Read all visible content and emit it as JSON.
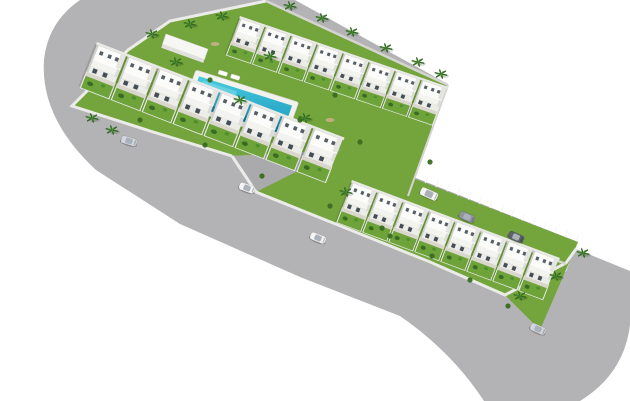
{
  "scene": {
    "description": "Aerial 3D architectural render of a residential development: two echelon blocks of white two-storey townhouses with private gardens, a communal lawn with swimming pool and palm trees, a wide light-gray perimeter road sweeping from the top-left corner to the bottom-right corner, and an internal parking street with marked bays and parked vehicles.",
    "background": "#ffffff",
    "colors": {
      "road": "#b3b3b5",
      "road_dark": "#aaaaac",
      "curb": "#ebebe9",
      "wall": "#d4d4d1",
      "grass": "#74a43c",
      "garden": "#6da339",
      "patio": "#d9d6cb",
      "pool_deck": "#f2f2ee",
      "pool_water_light": "#49ccdf",
      "pool_water_deep": "#1693ba",
      "pool_edge_shadow": "#0d7796",
      "house_roof": "#fbfbf9",
      "house_terrace": "#f3f3f0",
      "house_front": "#ecece9",
      "house_rear": "#e9e9e6",
      "house_shade": "#e4e4e1",
      "house_side_shade": "#cfcfcb",
      "window": "#454d56",
      "window_upper": "#565e66",
      "stripe": "#f6f6f6",
      "palm": "#2f6b1f",
      "palm_light": "#4c8a33",
      "bush": "#3a6b22",
      "bush_light": "#4f8f2e",
      "gravel": "#c8b38c",
      "car_white": "#f4f4f2",
      "car_silver": "#d3d6da",
      "car_gray": "#8f959b",
      "car_dark": "#5b6168",
      "car_cabin": "#a9b2ba",
      "shadow": "rgba(0,0,0,0.12)"
    },
    "roads": {
      "perimeter_path": "M 80,0 L 295,0 L 448,84 L 266,1 L 170,21 L 128,50 L 72,106 L 150,131 L 232,156 L 256,192 L 505,295 L 566,263 L 576,249 L 630,271 L 630,325 Q 624,374 580,401 L 484,401 Q 452,352 400,316 L 300,277 L 180,224 L 96,170 Q 40,118 44,60 Q 48,22 80,0 Z",
      "street_path": "M 340,148 L 578,242 L 566,264 L 352,182 Z",
      "junction_path": "M 232,156 L 340,150 L 352,182 L 256,192 Z",
      "inner_curb": "M 266,1 L 170,21 L 128,50 L 72,106 L 150,131 L 232,156",
      "lower_curb": "M 232,156 L 256,192 L 430,262 L 505,295 L 566,263 L 576,249"
    },
    "walls": {
      "upper_top_wall": "M 266,1 L 448,85",
      "upper_end_wall": "M 448,85 L 408,196",
      "lower_top_wall": "M 352,182 L 566,264"
    },
    "blocks": {
      "upper": {
        "poly": "265,0 448,86 408,197 340,150 232,156 150,131 72,106 128,50 170,21",
        "rows": [
          {
            "id": "upper-top-row",
            "count": 8,
            "start": [
              240,
              16
            ],
            "a1": [
              1.0,
              0.34
            ],
            "a2": [
              -0.27,
              0.72
            ]
          },
          {
            "id": "upper-bottom-row",
            "count": 8,
            "start": [
              97,
              42
            ],
            "a1": [
              1.19,
              0.46
            ],
            "a2": [
              -0.33,
              0.84
            ]
          }
        ]
      },
      "lower": {
        "poly": "340,150 578,242 540,330 505,295 256,192",
        "rows": [
          {
            "id": "lower-row",
            "count": 8,
            "start": [
              352,
              180
            ],
            "a1": [
              1.0,
              0.375
            ],
            "a2": [
              -0.3,
              0.78
            ]
          }
        ]
      }
    },
    "pool": {
      "origin": [
        196,
        70
      ],
      "axes": {
        "a1": [
          0.95,
          0.3
        ],
        "a2": [
          -0.34,
          0.94
        ]
      },
      "deck_size": [
        108,
        40
      ],
      "water_size": [
        98,
        30
      ],
      "loungers": 2
    },
    "community_building": {
      "origin": [
        166,
        34
      ],
      "size": [
        42,
        12
      ]
    },
    "parking": {
      "center_start": [
        346,
        165
      ],
      "center_end": [
        572,
        253
      ],
      "stripe_count": 22,
      "stripe_dir": [
        -0.33,
        0.94
      ],
      "offset": 8,
      "bay_length": 12
    },
    "cars": [
      {
        "x": 129,
        "y": 141,
        "rot": 17,
        "color": "car_silver",
        "kind": "car",
        "where": "perimeter-road"
      },
      {
        "x": 247,
        "y": 188,
        "rot": 20,
        "color": "car_white",
        "kind": "car",
        "where": "perimeter-road"
      },
      {
        "x": 318,
        "y": 238,
        "rot": 22,
        "color": "car_white",
        "kind": "car",
        "where": "perimeter-road"
      },
      {
        "x": 538,
        "y": 329,
        "rot": 24,
        "color": "car_silver",
        "kind": "car",
        "where": "perimeter-road"
      },
      {
        "x": 429,
        "y": 194,
        "rot": 24,
        "color": "car_white",
        "kind": "van",
        "where": "parking-street"
      },
      {
        "x": 467,
        "y": 217,
        "rot": 24,
        "color": "car_gray",
        "kind": "car",
        "where": "parking-street"
      },
      {
        "x": 516,
        "y": 237,
        "rot": 24,
        "color": "car_dark",
        "kind": "car",
        "where": "parking-street"
      }
    ],
    "palms": [
      [
        152,
        34
      ],
      [
        190,
        24
      ],
      [
        222,
        16
      ],
      [
        290,
        6
      ],
      [
        322,
        18
      ],
      [
        352,
        32
      ],
      [
        386,
        48
      ],
      [
        418,
        62
      ],
      [
        441,
        74
      ],
      [
        92,
        118
      ],
      [
        112,
        130
      ],
      [
        176,
        62
      ],
      [
        240,
        100
      ],
      [
        305,
        118
      ],
      [
        270,
        56
      ],
      [
        583,
        253
      ],
      [
        556,
        276
      ],
      [
        520,
        296
      ],
      [
        346,
        192
      ]
    ],
    "bushes": [
      [
        140,
        120
      ],
      [
        205,
        145
      ],
      [
        262,
        176
      ],
      [
        330,
        206
      ],
      [
        390,
        236
      ],
      [
        300,
        120
      ],
      [
        360,
        142
      ],
      [
        430,
        162
      ],
      [
        470,
        280
      ],
      [
        432,
        256
      ],
      [
        382,
        228
      ],
      [
        508,
        306
      ],
      [
        210,
        80
      ],
      [
        335,
        95
      ]
    ],
    "gravel": [
      [
        160,
        70
      ],
      [
        215,
        44
      ],
      [
        258,
        95
      ],
      [
        330,
        120
      ],
      [
        390,
        96
      ],
      [
        300,
        66
      ],
      [
        455,
        235
      ],
      [
        425,
        212
      ],
      [
        485,
        262
      ]
    ],
    "counts": {
      "houses_total": 24,
      "road_cars": 4,
      "parked_vehicles": 3,
      "palm_trees": 19
    }
  }
}
